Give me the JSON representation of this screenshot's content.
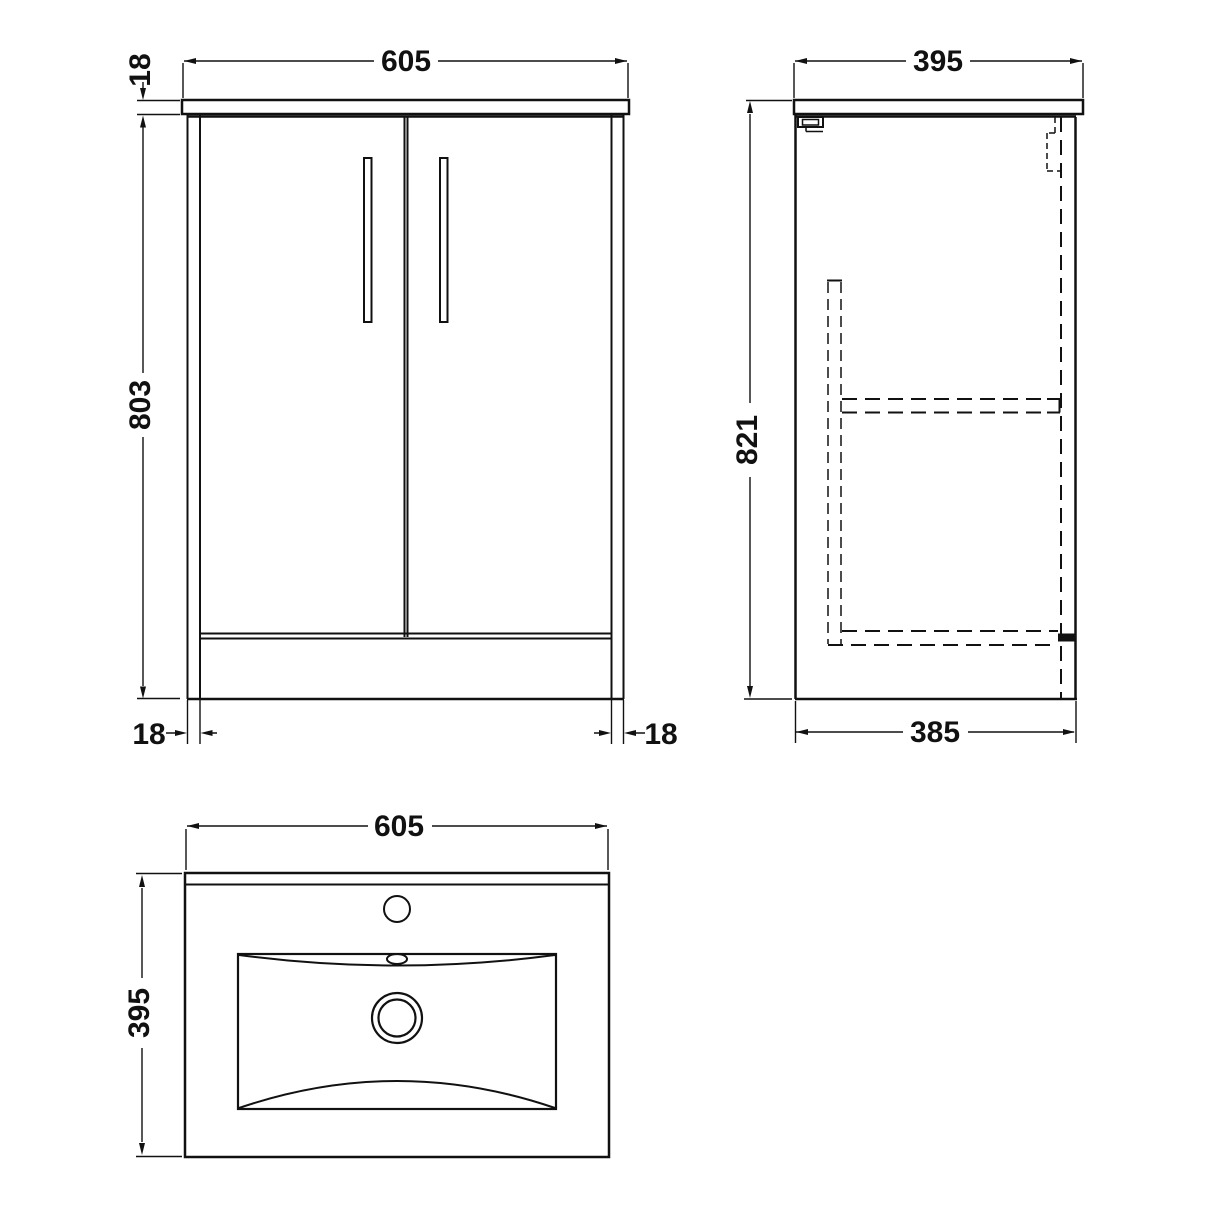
{
  "colors": {
    "line": "#111111",
    "background": "#ffffff"
  },
  "front_view": {
    "width_mm": "605",
    "counter_thickness_mm": "18",
    "height_mm": "803",
    "left_leg_mm": "18",
    "right_leg_mm": "18"
  },
  "side_view": {
    "depth_mm": "395",
    "height_mm": "821",
    "base_depth_mm": "385"
  },
  "plan_view": {
    "width_mm": "605",
    "depth_mm": "395"
  }
}
